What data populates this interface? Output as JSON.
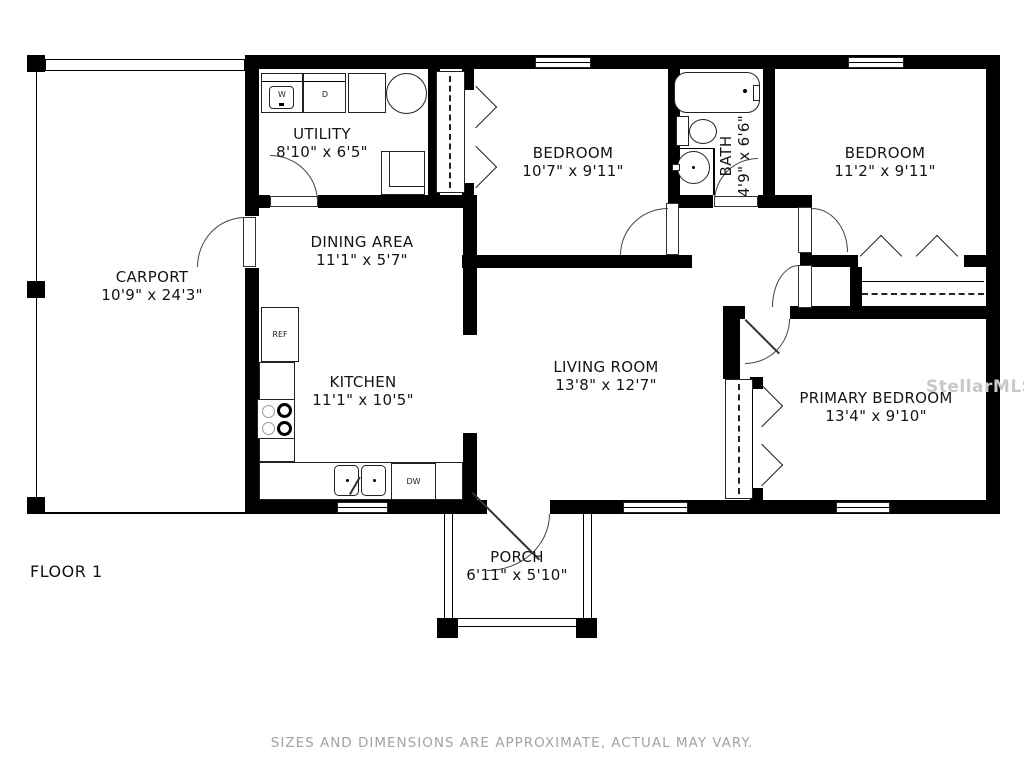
{
  "floor_label": "FLOOR 1",
  "disclaimer": "SIZES AND DIMENSIONS ARE APPROXIMATE, ACTUAL MAY VARY.",
  "watermark": "StellarMLS",
  "rooms": {
    "carport": {
      "name": "CARPORT",
      "dims": "10'9\" x 24'3\""
    },
    "utility": {
      "name": "UTILITY",
      "dims": "8'10\" x 6'5\""
    },
    "dining": {
      "name": "DINING AREA",
      "dims": "11'1\" x 5'7\""
    },
    "kitchen": {
      "name": "KITCHEN",
      "dims": "11'1\" x 10'5\""
    },
    "bedroom1": {
      "name": "BEDROOM",
      "dims": "10'7\" x 9'11\""
    },
    "bath": {
      "name": "BATH",
      "dims": "4'9\" x 6'6\""
    },
    "bedroom2": {
      "name": "BEDROOM",
      "dims": "11'2\" x 9'11\""
    },
    "living": {
      "name": "LIVING ROOM",
      "dims": "13'8\" x 12'7\""
    },
    "primary": {
      "name": "PRIMARY BEDROOM",
      "dims": "13'4\" x 9'10\""
    },
    "porch": {
      "name": "PORCH",
      "dims": "6'11\" x 5'10\""
    }
  },
  "fixtures": {
    "washer": "W",
    "dryer": "D",
    "fridge": "REF",
    "dishwasher": "DW"
  }
}
